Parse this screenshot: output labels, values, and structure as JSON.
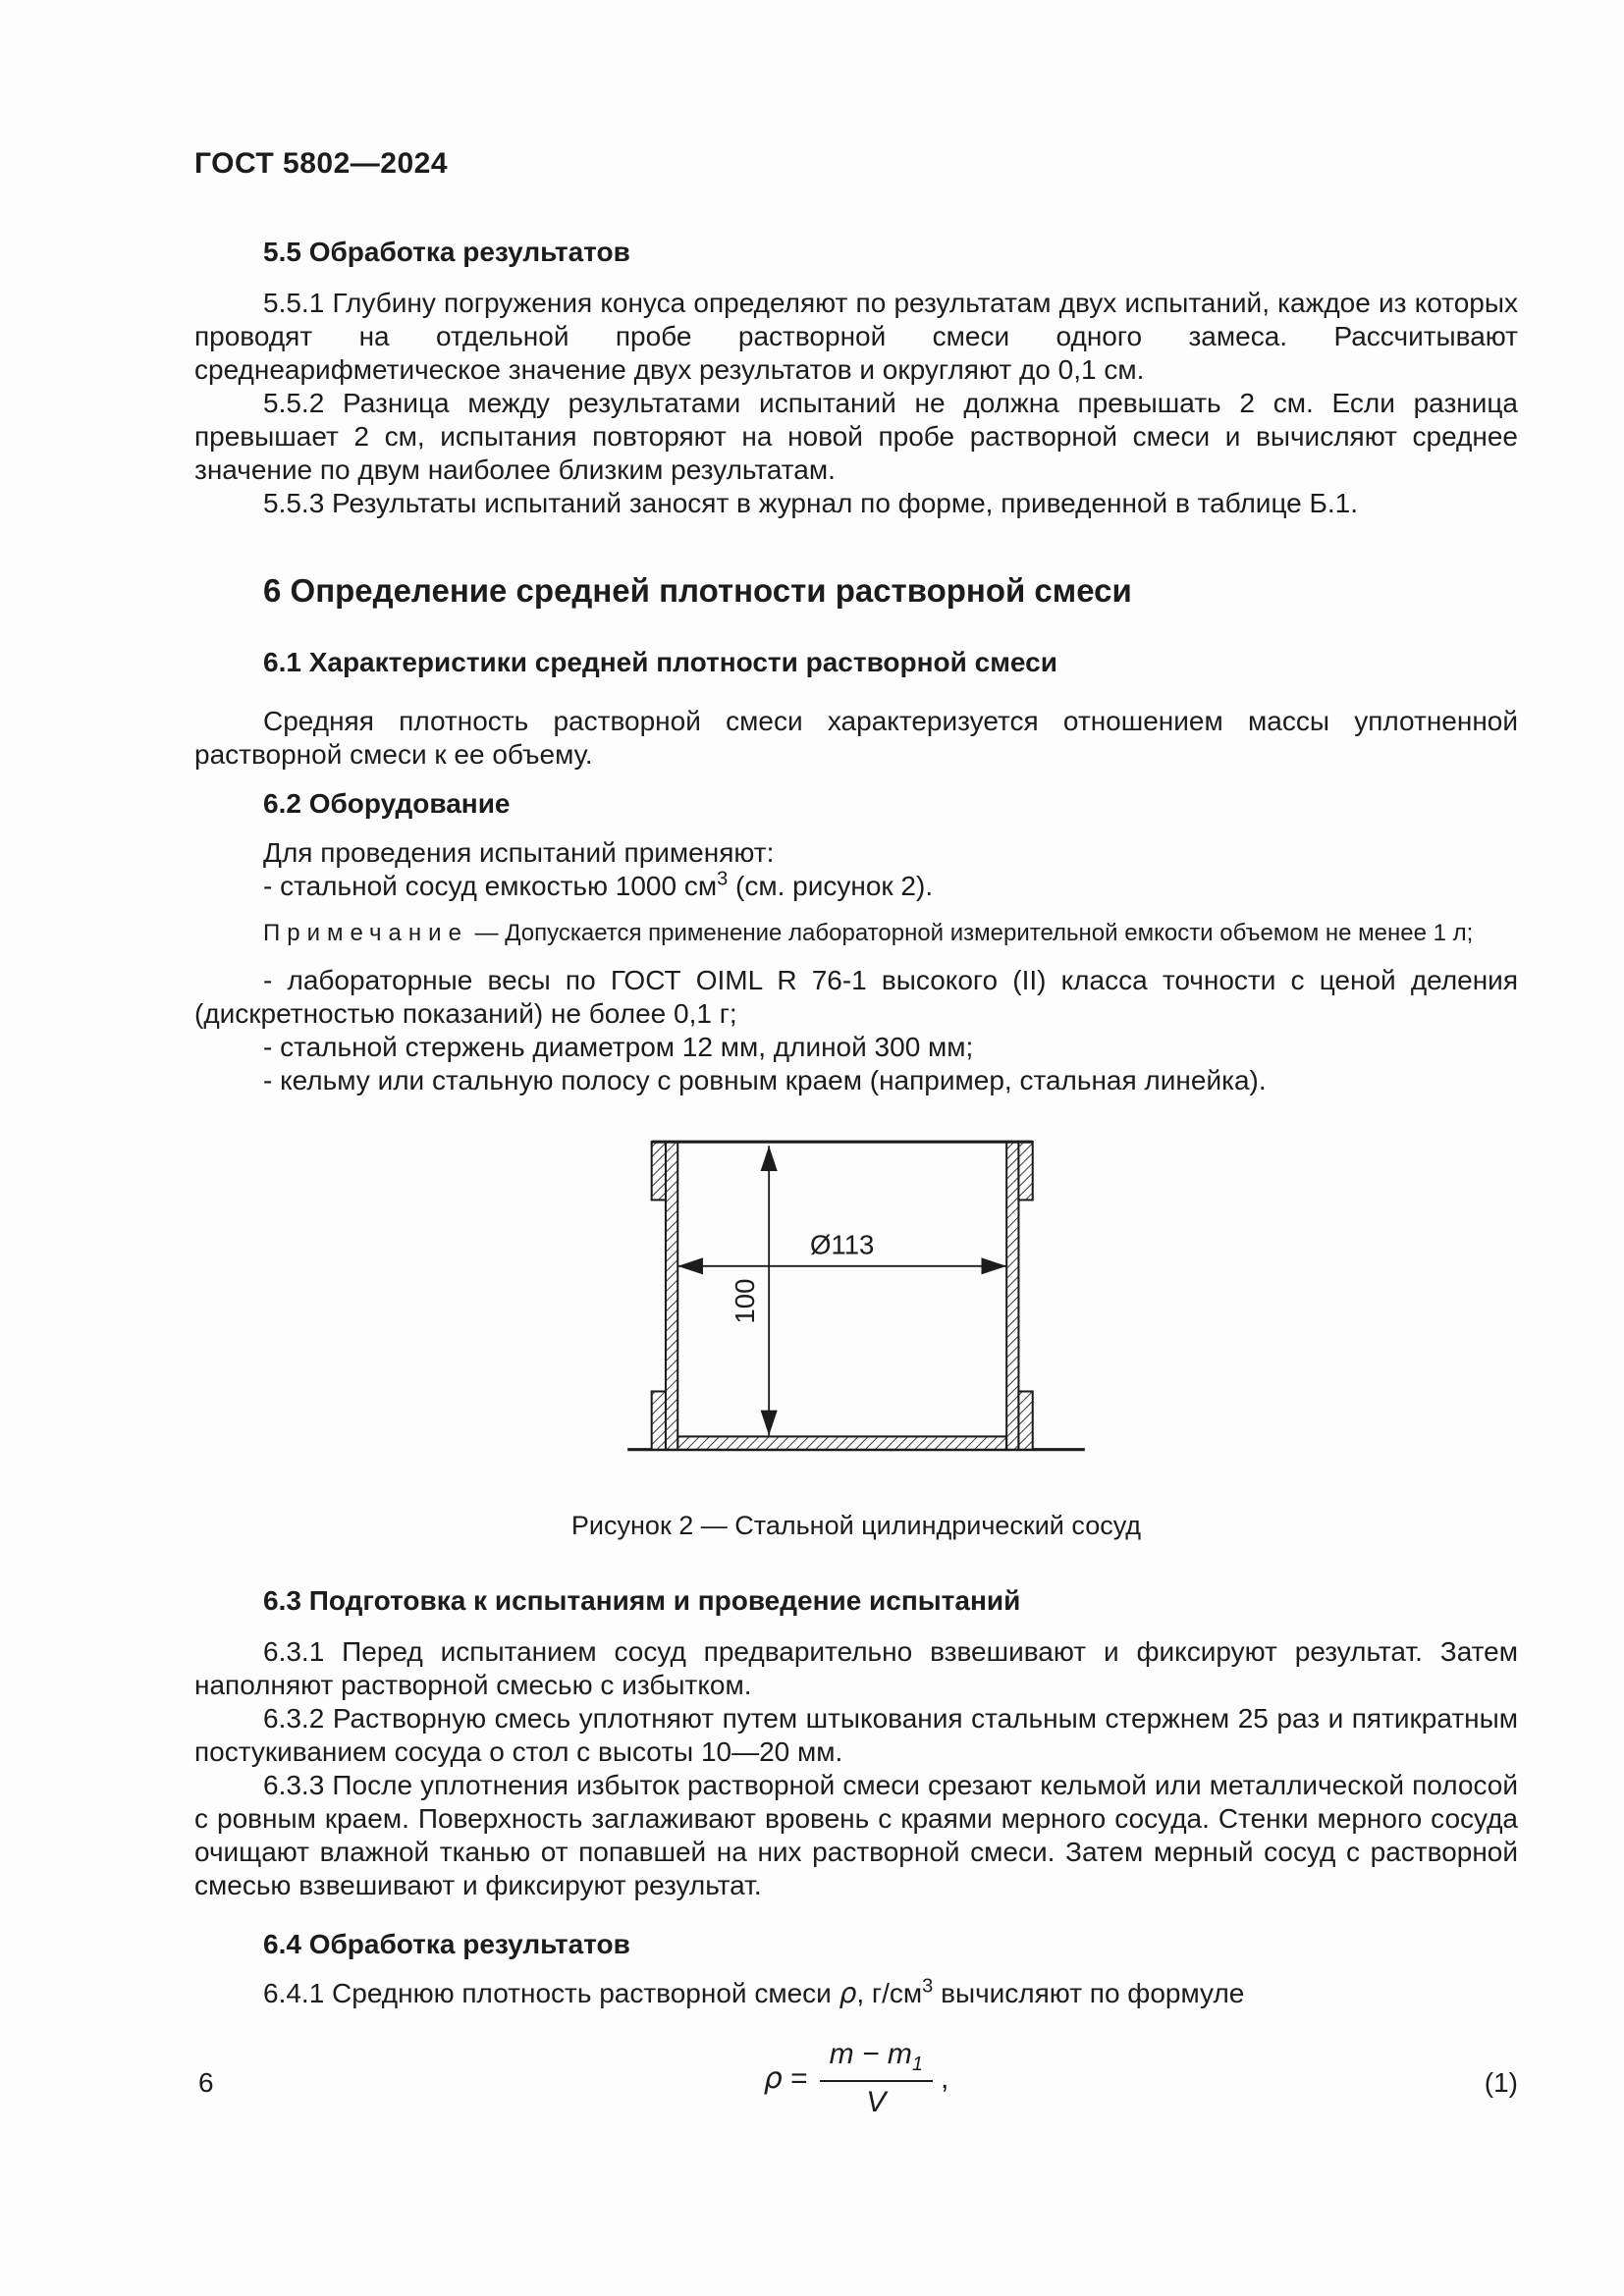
{
  "page": {
    "header": "ГОСТ 5802—2024",
    "page_number": "6"
  },
  "s55": {
    "title": "5.5 Обработка результатов",
    "p1": "5.5.1 Глубину погружения конуса определяют по результатам двух испытаний, каждое из которых проводят на отдельной пробе растворной смеси одного замеса. Рассчитывают среднеарифметическое значение двух результатов и округляют до 0,1 см.",
    "p2": "5.5.2 Разница между результатами испытаний не должна превышать 2 см. Если разница превышает 2 см, испытания повторяют на новой пробе растворной смеси и вычисляют среднее значение по двум наиболее близким результатам.",
    "p3": "5.5.3 Результаты испытаний заносят в журнал по форме, приведенной в таблице Б.1."
  },
  "s6": {
    "title": "6 Определение средней плотности растворной смеси",
    "s61": {
      "title": "6.1 Характеристики средней плотности растворной смеси",
      "p1": "Средняя плотность растворной смеси характеризуется отношением массы уплотненной растворной смеси к ее объему."
    },
    "s62": {
      "title": "6.2 Оборудование",
      "intro": "Для проведения испытаний применяют:",
      "item_vessel_pre": "- стальной сосуд емкостью 1000 см",
      "item_vessel_sup": "3",
      "item_vessel_post": " (см. рисунок 2).",
      "note_label": "Примечание",
      "note_text": "— Допускается применение лабораторной измерительной емкости объемом не менее 1 л;",
      "item_scales": "- лабораторные весы по ГОСТ OIML R 76-1 высокого (II) класса точности с ценой деления (дискретностью показаний) не более 0,1 г;",
      "item_rod": "- стальной стержень диаметром 12 мм, длиной 300 мм;",
      "item_trowel": "- кельму или стальную полосу с ровным краем (например, стальная линейка)."
    },
    "figure": {
      "dim_diameter": "Ø113",
      "dim_height": "100",
      "caption": "Рисунок 2 — Стальной цилиндрический сосуд"
    },
    "s63": {
      "title": "6.3 Подготовка к испытаниям и проведение испытаний",
      "p1": "6.3.1 Перед испытанием сосуд предварительно взвешивают и фиксируют результат. Затем наполняют растворной смесью с избытком.",
      "p2": "6.3.2 Растворную смесь уплотняют путем штыкования стальным стержнем 25 раз и пятикратным постукиванием сосуда о стол с высоты 10—20 мм.",
      "p3": "6.3.3 После уплотнения избыток растворной смеси срезают кельмой или металлической полосой с ровным краем. Поверхность заглаживают вровень с краями мерного сосуда. Стенки мерного сосуда очищают влажной тканью от попавшей на них растворной смеси. Затем мерный сосуд с растворной смесью взвешивают и фиксируют результат."
    },
    "s64": {
      "title": "6.4 Обработка результатов",
      "p1_pre": "6.4.1 Среднюю плотность растворной смеси ",
      "p1_rho": "ρ",
      "p1_mid": ", г/см",
      "p1_sup": "3",
      "p1_post": " вычисляют по формуле"
    }
  },
  "formula": {
    "lhs": "ρ",
    "eq": "=",
    "num_main": "m − m",
    "num_sub": "1",
    "den": "V",
    "trailing": ",",
    "number": "(1)"
  }
}
